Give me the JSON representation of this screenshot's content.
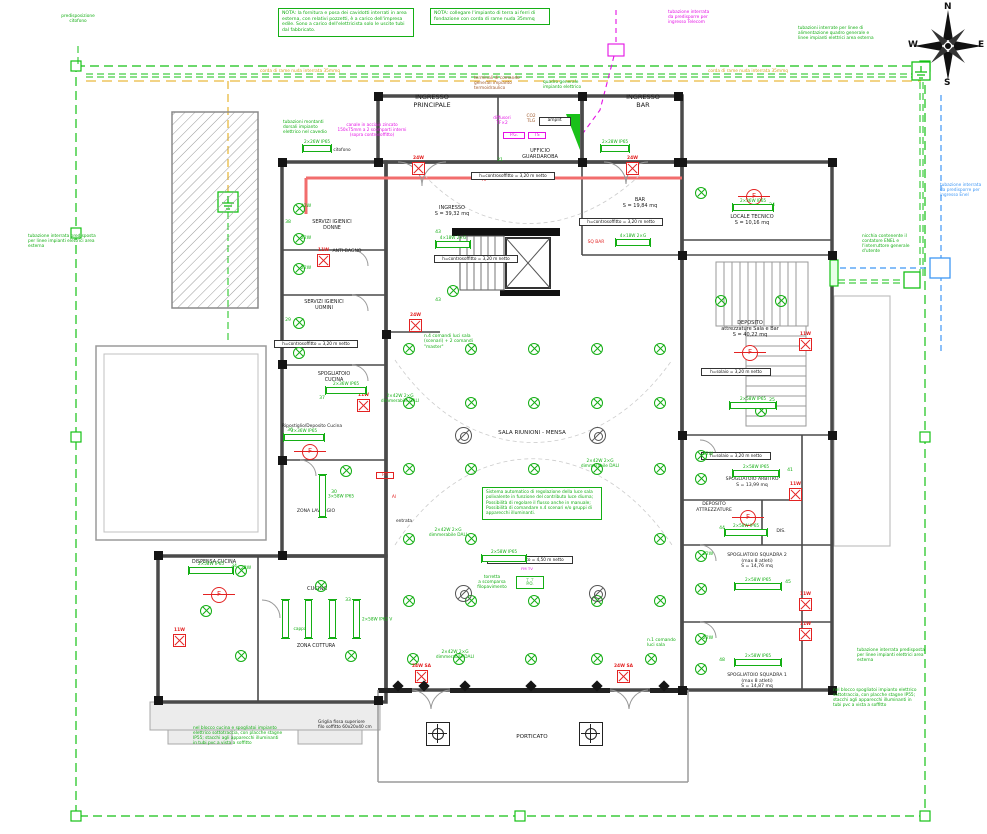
{
  "compass": {
    "n": "N",
    "e": "E",
    "s": "S",
    "w": "W"
  },
  "notes": {
    "nota_cavidotti": "NOTA: la fornitura e posa dei cavidotti interrati in area esterna, con relativi pozzetti, è a carico dell'impresa edile. Sono a carico dell'elettricista solo le uscite tubi dal fabbricato.",
    "nota_terra": "NOTA: collegare l'impianto di terra ai ferri di fondazione con corda di rame nuda 35mmq"
  },
  "colors": {
    "cad_green": "#14ae14",
    "magenta": "#e410e4",
    "blue": "#3f97f5",
    "orange": "#d9a520",
    "red": "#e32222",
    "brown": "#a05a2c"
  },
  "labels": [
    {
      "n": "room-ingresso-principale",
      "t": "INGRESSO\nPRINCIPALE",
      "x": 432,
      "y": 94,
      "c": "k",
      "fs": 6.5,
      "w": 80
    },
    {
      "n": "room-ingresso-bar",
      "t": "INGRESSO\nBAR",
      "x": 643,
      "y": 94,
      "c": "k",
      "fs": 6.5,
      "w": 60
    },
    {
      "n": "room-ufficio-guardaroba",
      "t": "UFFICIO\nGUARDAROBA",
      "x": 540,
      "y": 148,
      "c": "k",
      "fs": 5,
      "w": 60
    },
    {
      "n": "room-ingresso",
      "t": "INGRESSO\nS = 39,32 mq",
      "x": 452,
      "y": 205,
      "c": "k",
      "fs": 5,
      "w": 60
    },
    {
      "n": "room-bar",
      "t": "BAR\nS = 19,84 mq",
      "x": 640,
      "y": 197,
      "c": "k",
      "fs": 5,
      "w": 60
    },
    {
      "n": "room-locale-tecnico",
      "t": "LOCALE TECNICO\nS = 10,16 mq",
      "x": 752,
      "y": 214,
      "c": "k",
      "fs": 5,
      "w": 70
    },
    {
      "n": "room-deposito-sala-bar",
      "t": "DEPOSITO\nattrezzature Sala e Bar\nS = 40,22 mq",
      "x": 750,
      "y": 320,
      "c": "k",
      "fs": 5,
      "w": 80
    },
    {
      "n": "room-spogliatoio-arbitro",
      "t": "SPOGLIATOIO ARBITRO\nS = 13,99 mq",
      "x": 752,
      "y": 477,
      "c": "k",
      "fs": 4.6,
      "w": 80
    },
    {
      "n": "room-deposito-attrezzature",
      "t": "DEPOSITO\nATTREZZATURE",
      "x": 714,
      "y": 502,
      "c": "k",
      "fs": 4.6,
      "w": 60
    },
    {
      "n": "room-spogliatoio-squadra-2",
      "t": "SPOGLIATOIO SQUADRA 2\n(max 8 atleti)\nS = 14,76 mq",
      "x": 757,
      "y": 553,
      "c": "k",
      "fs": 4.6,
      "w": 84
    },
    {
      "n": "room-spogliatoio-squadra-1",
      "t": "SPOGLIATOIO SQUADRA 1\n(max 8 atleti)\nS = 14,87 mq",
      "x": 757,
      "y": 673,
      "c": "k",
      "fs": 4.6,
      "w": 84
    },
    {
      "n": "room-dis",
      "t": "DIS.",
      "x": 781,
      "y": 529,
      "c": "k",
      "fs": 4.6,
      "w": 20
    },
    {
      "n": "room-servizi-donne",
      "t": "SERVIZI IGIENICI\nDONNE",
      "x": 332,
      "y": 220,
      "c": "k",
      "fs": 4.8,
      "w": 60
    },
    {
      "n": "room-anti-bagno",
      "t": "ANTI-BAGNO",
      "x": 347,
      "y": 249,
      "c": "k",
      "fs": 4.6,
      "w": 50
    },
    {
      "n": "room-servizi-uomini",
      "t": "SERVIZI IGIENICI\nUOMINI",
      "x": 324,
      "y": 300,
      "c": "k",
      "fs": 4.8,
      "w": 60
    },
    {
      "n": "room-spogliatoio-cucina",
      "t": "SPOGLIATOIO\nCUCINA",
      "x": 334,
      "y": 372,
      "c": "k",
      "fs": 4.8,
      "w": 54
    },
    {
      "n": "room-ripostiglio",
      "t": "Ripostiglio/Deposito Cucina",
      "x": 312,
      "y": 424,
      "c": "k",
      "fs": 4.4,
      "w": 80
    },
    {
      "n": "room-zona-lavaggio",
      "t": "ZONA LAVAGGIO",
      "x": 316,
      "y": 509,
      "c": "k",
      "fs": 4.6,
      "w": 60
    },
    {
      "n": "room-dispensa-cucina",
      "t": "DISPENSA CUCINA",
      "x": 214,
      "y": 560,
      "c": "k",
      "fs": 4.8,
      "w": 66
    },
    {
      "n": "room-cucina",
      "t": "CUCINA",
      "x": 317,
      "y": 586,
      "c": "k",
      "fs": 5.2,
      "w": 40
    },
    {
      "n": "room-zona-cottura",
      "t": "ZONA COTTURA",
      "x": 316,
      "y": 644,
      "c": "k",
      "fs": 4.8,
      "w": 60
    },
    {
      "n": "room-sala-riunioni",
      "t": "SALA RIUNIONI - MENSA",
      "x": 532,
      "y": 430,
      "c": "k",
      "fs": 5.6,
      "w": 110
    },
    {
      "n": "room-porticato",
      "t": "PORTICATO",
      "x": 532,
      "y": 734,
      "c": "k",
      "fs": 5.6,
      "w": 60
    },
    {
      "n": "label-entrata",
      "t": "entrata",
      "x": 404,
      "y": 519,
      "c": "k",
      "fs": 4.4,
      "w": 30
    },
    {
      "n": "label-cappa",
      "t": "cappa",
      "x": 300,
      "y": 627,
      "fs": 4.3,
      "w": 26
    },
    {
      "n": "label-citofono",
      "t": "citofono",
      "x": 342,
      "y": 148,
      "c": "k",
      "fs": 4.3,
      "w": 34
    },
    {
      "n": "label-amplif",
      "t": "amplif.",
      "x": 552,
      "y": 117,
      "c": "k",
      "fs": 4.4,
      "w": 26,
      "bx": true
    },
    {
      "n": "label-sq-bar",
      "t": "SQ BAR",
      "x": 596,
      "y": 240,
      "c": "r",
      "fs": 4.4,
      "w": 30
    },
    {
      "n": "label-al-1",
      "t": "Al",
      "x": 394,
      "y": 495,
      "c": "r",
      "fs": 4.4,
      "w": 12
    },
    {
      "n": "label-al-2",
      "t": "Al",
      "x": 484,
      "y": 178,
      "c": "r",
      "fs": 4.4,
      "w": 12
    },
    {
      "n": "label-fm",
      "t": "FM",
      "x": 383,
      "y": 472,
      "c": "r",
      "fs": 4,
      "w": 14,
      "bxr": true
    },
    {
      "n": "label-diffusori",
      "t": "diffusori\nTF×2",
      "x": 502,
      "y": 116,
      "c": "m",
      "fs": 4.3,
      "w": 34
    },
    {
      "n": "label-co2-tlg",
      "t": "CO2\nTLG",
      "x": 531,
      "y": 114,
      "c": "br",
      "fs": 4.3,
      "w": 20
    },
    {
      "n": "label-pg",
      "t": "P.G.",
      "x": 512,
      "y": 132,
      "c": "m",
      "fs": 4.3,
      "w": 18,
      "bxm": true
    },
    {
      "n": "label-ts",
      "t": "TS",
      "x": 535,
      "y": 132,
      "c": "m",
      "fs": 4.3,
      "w": 14,
      "bxm": true
    },
    {
      "n": "label-fmtv",
      "t": "FM TV",
      "x": 527,
      "y": 567,
      "c": "m",
      "fs": 3.9,
      "w": 24
    },
    {
      "n": "label-torretta-box",
      "t": "⊤ ⊤\nP.O.",
      "x": 527,
      "y": 576,
      "fs": 4,
      "w": 22,
      "tb": true
    },
    {
      "n": "note-torretta",
      "t": "torretta\na scomparsa\nfilopavimento",
      "x": 492,
      "y": 575,
      "fs": 4.3,
      "w": 44
    },
    {
      "n": "label-corda-left",
      "t": "corda di rame nuda interrata 35mmq",
      "x": 300,
      "y": 69,
      "c": "o",
      "fs": 4.3,
      "w": 130
    },
    {
      "n": "label-corda-right",
      "t": "corda di rame nuda interrata 35mmq",
      "x": 748,
      "y": 69,
      "c": "o",
      "fs": 4.3,
      "w": 130
    },
    {
      "n": "note-telecom",
      "t": "tubazione interrata\nda predisporre per\ningresso Telecom",
      "x": 668,
      "y": 10,
      "c": "m",
      "fs": 4.3,
      "w": 64,
      "al": "l"
    },
    {
      "n": "note-alimentazione",
      "t": "tubazioni interrate per linee di\nalimentazione quadro generale e\nlinee impianti elettrici area esterna",
      "x": 798,
      "y": 26,
      "fs": 4.3,
      "w": 106,
      "al": "l"
    },
    {
      "n": "note-enel",
      "t": "tubazione interrata\nda predisporre per\ningresso Enel",
      "x": 940,
      "y": 183,
      "c": "b",
      "fs": 4.3,
      "w": 46,
      "al": "l"
    },
    {
      "n": "note-nicchia",
      "t": "nicchia contenente il\ncontatore ENEL e\nl'interruttore generale\nd'utente",
      "x": 862,
      "y": 234,
      "fs": 4.3,
      "w": 56,
      "al": "l"
    },
    {
      "n": "note-tubazione-left",
      "t": "tubazione interrata predisposta\nper linee impianti elettrici area\nesterna",
      "x": 28,
      "y": 234,
      "fs": 4.3,
      "w": 86,
      "al": "l"
    },
    {
      "n": "note-tubazione-bottom-right",
      "t": "tubazione interrata predisposta\nper linee impianti elettrici area\nesterna",
      "x": 857,
      "y": 648,
      "fs": 4.3,
      "w": 86,
      "al": "l"
    },
    {
      "n": "note-spogliatoi",
      "t": "nel blocco spogliatoi impianto elettrico\nsottotraccia, con placche stagne IP55;\nstacchi agli apparecchi illuminanti in\ntubi pvc a vista a soffitto",
      "x": 833,
      "y": 688,
      "fs": 4.3,
      "w": 110,
      "al": "l"
    },
    {
      "n": "note-cucina",
      "t": "nel blocco cucina e spogliatoi impianto\nelettrico sottotraccia, con placche stagne\nIP55; stacchi agli apparecchi illuminanti\nin tubi pvc a vista a soffitto",
      "x": 193,
      "y": 726,
      "fs": 4.3,
      "w": 118,
      "al": "l"
    },
    {
      "n": "note-griglia",
      "t": "Griglia fissa superiore\nfilo soffitto 60x20x40 cm",
      "x": 318,
      "y": 720,
      "c": "k",
      "fs": 4.3,
      "w": 64,
      "al": "l"
    },
    {
      "n": "note-montanti",
      "t": "tubazioni montanti\ndorsali impianto\nelettrico nel cavedio",
      "x": 283,
      "y": 120,
      "fs": 4.3,
      "w": 56,
      "al": "l"
    },
    {
      "n": "note-quadro",
      "t": "quadro generale\nimpianto elettrico",
      "x": 543,
      "y": 80,
      "fs": 4.3,
      "w": 54,
      "al": "l"
    },
    {
      "n": "note-terminali",
      "t": "terminali di comando\ngenerali impianto\ntermoidraulico",
      "x": 474,
      "y": 76,
      "c": "br",
      "fs": 4.3,
      "w": 60,
      "al": "l"
    },
    {
      "n": "note-canale",
      "t": "canale in acciaio zincato\n150x75mm a 2 scomparti interni\n(sopra controsoffitto)",
      "x": 372,
      "y": 122,
      "c": "m",
      "fs": 4.2,
      "w": 104
    },
    {
      "n": "note-predisposizione-citofono",
      "t": "predisposizione\ncitofono",
      "x": 78,
      "y": 14,
      "fs": 4.3,
      "w": 52
    },
    {
      "n": "note-comandi-sala",
      "t": "n.4 comandi luci sala\n(scenari) + 2 comandi\n\"master\"",
      "x": 424,
      "y": 334,
      "fs": 4.4,
      "w": 66,
      "al": "l"
    },
    {
      "n": "note-comando-1",
      "t": "n.1 comando\nluci sala",
      "x": 647,
      "y": 638,
      "fs": 4.4,
      "w": 44,
      "al": "l"
    },
    {
      "n": "label-dali-1",
      "t": "2×42W 2×G\ndimmerabile DALI",
      "x": 600,
      "y": 459,
      "fs": 4.3,
      "w": 54
    },
    {
      "n": "label-dali-2",
      "t": "2×42W 2×G\ndimmerabile DALI",
      "x": 448,
      "y": 528,
      "fs": 4.3,
      "w": 54
    },
    {
      "n": "label-dali-3",
      "t": "2×42W 2×G\ndimmerabile DALI",
      "x": 400,
      "y": 394,
      "fs": 4.3,
      "w": 54
    },
    {
      "n": "label-dali-4",
      "t": "2×42W 2×G\ndimmerabile DALI",
      "x": 455,
      "y": 650,
      "fs": 4.3,
      "w": 54
    },
    {
      "n": "h-guardaroba",
      "t": "h=controsoffitto = 3,20 m netto",
      "x": 510,
      "y": 172,
      "bx": true,
      "w": 78
    },
    {
      "n": "h-ingresso",
      "t": "h=controsoffitto = 3,20 m netto",
      "x": 473,
      "y": 255,
      "bx": true,
      "w": 78
    },
    {
      "n": "h-bar",
      "t": "h=controsoffitto = 3,20 m netto",
      "x": 618,
      "y": 218,
      "bx": true,
      "w": 78
    },
    {
      "n": "h-uomini",
      "t": "h=controsoffitto = 3,20 m netto",
      "x": 313,
      "y": 340,
      "bx": true,
      "w": 78
    },
    {
      "n": "h-deposito",
      "t": "h=solaio = 3,20 m netto",
      "x": 733,
      "y": 368,
      "bx": true,
      "w": 64
    },
    {
      "n": "h-arbitro",
      "t": "h=solaio = 3,20 m netto",
      "x": 733,
      "y": 452,
      "bx": true,
      "w": 64
    },
    {
      "n": "h-sala",
      "t": "h=controsoffitto = 4,50 m netto",
      "x": 527,
      "y": 556,
      "bx": true,
      "w": 80
    },
    {
      "n": "num-43a",
      "t": "43",
      "x": 438,
      "y": 230,
      "w": 12
    },
    {
      "n": "num-43b",
      "t": "43",
      "x": 438,
      "y": 298,
      "w": 12
    },
    {
      "n": "num-38",
      "t": "38",
      "x": 288,
      "y": 220,
      "w": 12
    },
    {
      "n": "num-29",
      "t": "29",
      "x": 288,
      "y": 318,
      "w": 12
    },
    {
      "n": "num-37",
      "t": "37",
      "x": 322,
      "y": 396,
      "w": 12
    },
    {
      "n": "num-36",
      "t": "36",
      "x": 290,
      "y": 428,
      "w": 12
    },
    {
      "n": "num-30",
      "t": "30",
      "x": 334,
      "y": 490,
      "w": 12
    },
    {
      "n": "num-34",
      "t": "34",
      "x": 234,
      "y": 564,
      "w": 12
    },
    {
      "n": "num-33",
      "t": "33",
      "x": 348,
      "y": 598,
      "w": 12
    },
    {
      "n": "num-25",
      "t": "25",
      "x": 772,
      "y": 398,
      "w": 12
    },
    {
      "n": "num-24",
      "t": "24",
      "x": 772,
      "y": 203,
      "w": 12
    },
    {
      "n": "num-41",
      "t": "41",
      "x": 790,
      "y": 468,
      "w": 12
    },
    {
      "n": "num-44",
      "t": "44",
      "x": 722,
      "y": 526,
      "w": 12
    },
    {
      "n": "num-45",
      "t": "45",
      "x": 788,
      "y": 580,
      "w": 12
    },
    {
      "n": "num-48",
      "t": "48",
      "x": 722,
      "y": 658,
      "w": 12
    },
    {
      "n": "num-21",
      "t": "21",
      "x": 500,
      "y": 158,
      "w": 12
    },
    {
      "n": "w22-1",
      "t": "22W",
      "x": 306,
      "y": 204,
      "w": 18
    },
    {
      "n": "w22-2",
      "t": "22W",
      "x": 306,
      "y": 236,
      "w": 18
    },
    {
      "n": "w22-3",
      "t": "22W",
      "x": 306,
      "y": 266,
      "w": 18
    },
    {
      "n": "w22-4",
      "t": "22W",
      "x": 246,
      "y": 566,
      "w": 18
    },
    {
      "n": "w22-5",
      "t": "22W",
      "x": 708,
      "y": 452,
      "w": 18
    },
    {
      "n": "w22-6",
      "t": "22W",
      "x": 708,
      "y": 552,
      "w": 18
    },
    {
      "n": "w22-7",
      "t": "22W",
      "x": 708,
      "y": 636,
      "w": 18
    }
  ],
  "sala_note": "Sistema automatico di regolazione della luce sala polivalente in funzione del contributo luce diurna; Possibilità di regolare il flusso anche in manuale; Possibilità di comandare n.4 scenari e/o gruppi di apparecchi illuminanti.",
  "symbols": {
    "lights": [
      [
        408,
        348
      ],
      [
        470,
        348
      ],
      [
        533,
        348
      ],
      [
        596,
        348
      ],
      [
        659,
        348
      ],
      [
        408,
        402
      ],
      [
        470,
        402
      ],
      [
        533,
        402
      ],
      [
        596,
        402
      ],
      [
        659,
        402
      ],
      [
        408,
        468
      ],
      [
        470,
        468
      ],
      [
        533,
        468
      ],
      [
        596,
        468
      ],
      [
        659,
        468
      ],
      [
        408,
        538
      ],
      [
        470,
        538
      ],
      [
        659,
        538
      ],
      [
        408,
        600
      ],
      [
        470,
        600
      ],
      [
        533,
        600
      ],
      [
        596,
        600
      ],
      [
        659,
        600
      ],
      [
        412,
        658
      ],
      [
        458,
        658
      ],
      [
        530,
        658
      ],
      [
        596,
        658
      ],
      [
        650,
        658
      ],
      [
        298,
        208
      ],
      [
        298,
        238
      ],
      [
        298,
        268
      ],
      [
        298,
        322
      ],
      [
        298,
        352
      ],
      [
        240,
        570
      ],
      [
        205,
        610
      ],
      [
        240,
        655
      ],
      [
        320,
        585
      ],
      [
        350,
        655
      ],
      [
        345,
        470
      ],
      [
        700,
        192
      ],
      [
        700,
        455
      ],
      [
        700,
        478
      ],
      [
        700,
        555
      ],
      [
        700,
        588
      ],
      [
        700,
        638
      ],
      [
        700,
        668
      ],
      [
        720,
        300
      ],
      [
        780,
        300
      ],
      [
        760,
        410
      ],
      [
        452,
        290
      ]
    ],
    "dlights": [
      [
        463,
        435
      ],
      [
        597,
        435
      ],
      [
        463,
        593
      ],
      [
        597,
        593
      ]
    ],
    "emergency": [
      [
        418,
        168,
        "24W"
      ],
      [
        632,
        168,
        "24W"
      ],
      [
        415,
        325,
        "24W"
      ],
      [
        421,
        676,
        "24W SA"
      ],
      [
        623,
        676,
        "24W SA"
      ],
      [
        363,
        405,
        "11W"
      ],
      [
        179,
        640,
        "11W"
      ],
      [
        795,
        494,
        "11W"
      ],
      [
        805,
        344,
        "11W"
      ],
      [
        805,
        604,
        "11W"
      ],
      [
        805,
        634,
        "11W"
      ],
      [
        323,
        260,
        "11W"
      ]
    ],
    "fans": [
      [
        218,
        594
      ],
      [
        309,
        451
      ],
      [
        753,
        196
      ],
      [
        749,
        352
      ],
      [
        747,
        517
      ]
    ],
    "lamps_h": [
      [
        452,
        244,
        32,
        "4×18W 2×G"
      ],
      [
        632,
        242,
        32,
        "4×18W 2×G"
      ],
      [
        345,
        390,
        38,
        "2×36W IP65"
      ],
      [
        303,
        437,
        38,
        "2×36W IP65"
      ],
      [
        210,
        570,
        42,
        "2×58W IP65"
      ],
      [
        503,
        558,
        42,
        "2×58W IP65"
      ],
      [
        752,
        207,
        38,
        "2×36W IP65"
      ],
      [
        752,
        405,
        44,
        "2×58W IP65"
      ],
      [
        755,
        473,
        44,
        "2×58W IP65"
      ],
      [
        745,
        532,
        40,
        "2×58W IP65"
      ],
      [
        757,
        586,
        44,
        "2×58W IP65"
      ],
      [
        757,
        662,
        44,
        "2×58W IP65"
      ],
      [
        316,
        148,
        26,
        "2×26W IP65"
      ],
      [
        614,
        148,
        26,
        "2×28W IP65"
      ]
    ],
    "lamps_v": [
      [
        322,
        495,
        40,
        "3×58W IP65"
      ],
      [
        285,
        618,
        36,
        ""
      ],
      [
        308,
        618,
        36,
        ""
      ],
      [
        332,
        618,
        36,
        ""
      ],
      [
        356,
        618,
        36,
        "2×58W IP65 V"
      ]
    ],
    "floor_boxes": [
      [
        437,
        733
      ],
      [
        590,
        733
      ]
    ],
    "wall_leds": [
      [
        398,
        686
      ],
      [
        424,
        686
      ],
      [
        465,
        686
      ],
      [
        531,
        686
      ],
      [
        597,
        686
      ],
      [
        664,
        686
      ]
    ]
  }
}
